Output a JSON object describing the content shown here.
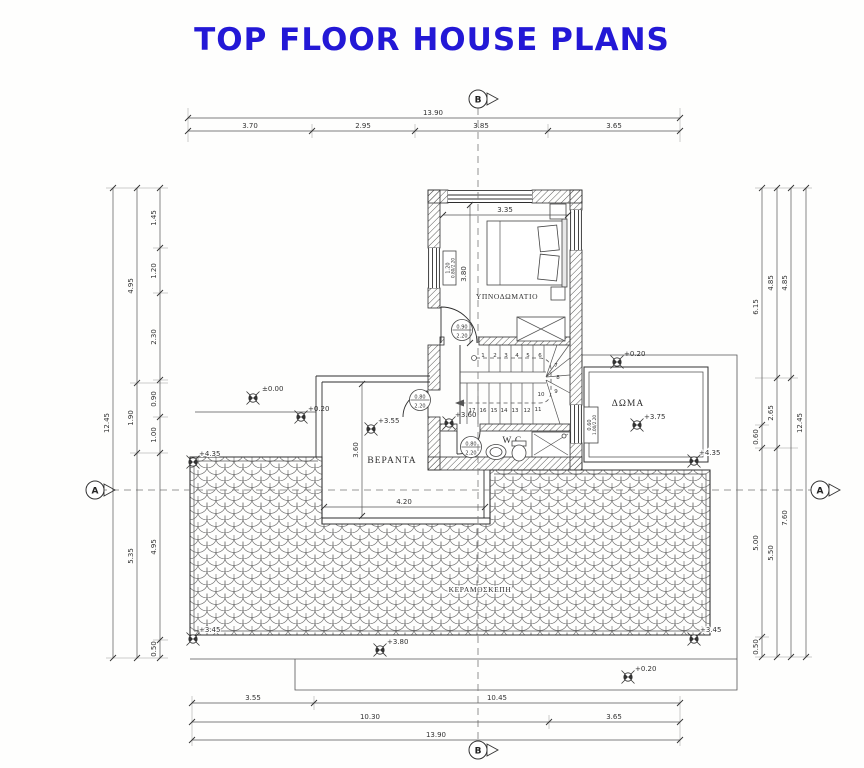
{
  "title": "TOP FLOOR HOUSE PLANS",
  "colors": {
    "title": "#2318d6",
    "ink": "#333333"
  },
  "section_markers": {
    "top": "B",
    "bottom": "B",
    "left": "A",
    "right": "A"
  },
  "rooms": {
    "bedroom": "ΥΠΝΟΔΩΜΑΤΙΟ",
    "wc": "W.C.",
    "veranda": "ΒΕΡΑΝΤΑ",
    "roof_terrace": "ΔΩΜΑ",
    "tiled_roof": "ΚΕΡΑΜΟΣΚΕΠΗ"
  },
  "levels": {
    "zero": "±0.00",
    "v020": "+0.20",
    "v355": "+3.55",
    "v360": "+3.60",
    "v375": "+3.75",
    "v380": "+3.80",
    "v435": "+4.35",
    "v345": "+3.45"
  },
  "dims": {
    "top_total": "13.90",
    "top": [
      "3.70",
      "2.95",
      "3.85",
      "3.65"
    ],
    "bottom_row1": [
      "3.55",
      "10.45"
    ],
    "bottom_row2": [
      "10.30",
      "3.65"
    ],
    "bottom_total": "13.90",
    "left_outer": "12.45",
    "left_mid": [
      "4.95",
      "1.90",
      "5.35"
    ],
    "left_inner": [
      "1.45",
      "1.20",
      "2.30",
      "0.90",
      "1.00",
      "4.95",
      "0.50"
    ],
    "right_inner": [
      "6.15",
      "0.60",
      "5.00",
      "0.50"
    ],
    "right_mid": [
      "4.85",
      "2.65",
      "5.50"
    ],
    "right_mid2": [
      "4.85",
      "7.60"
    ],
    "right_outer": "12.45",
    "bedroom_width": "3.35",
    "bedroom_depth": "3.80",
    "veranda_depth": "3.60",
    "veranda_width": "4.20"
  },
  "openings": {
    "bedroom_window": [
      "1.20",
      "0.80/2.20"
    ],
    "bedroom_door": [
      "0.90",
      "2.20"
    ],
    "veranda_door": [
      "0.80",
      "2.20"
    ],
    "wc_door": [
      "0.80",
      "2.20"
    ],
    "roof_room_window": [
      "0.60",
      "1.00/2.20"
    ]
  },
  "stairs": {
    "steps": [
      "1",
      "2",
      "3",
      "4",
      "5",
      "6",
      "7",
      "8",
      "9",
      "10",
      "11",
      "12",
      "13",
      "14",
      "15",
      "16",
      "17"
    ]
  }
}
